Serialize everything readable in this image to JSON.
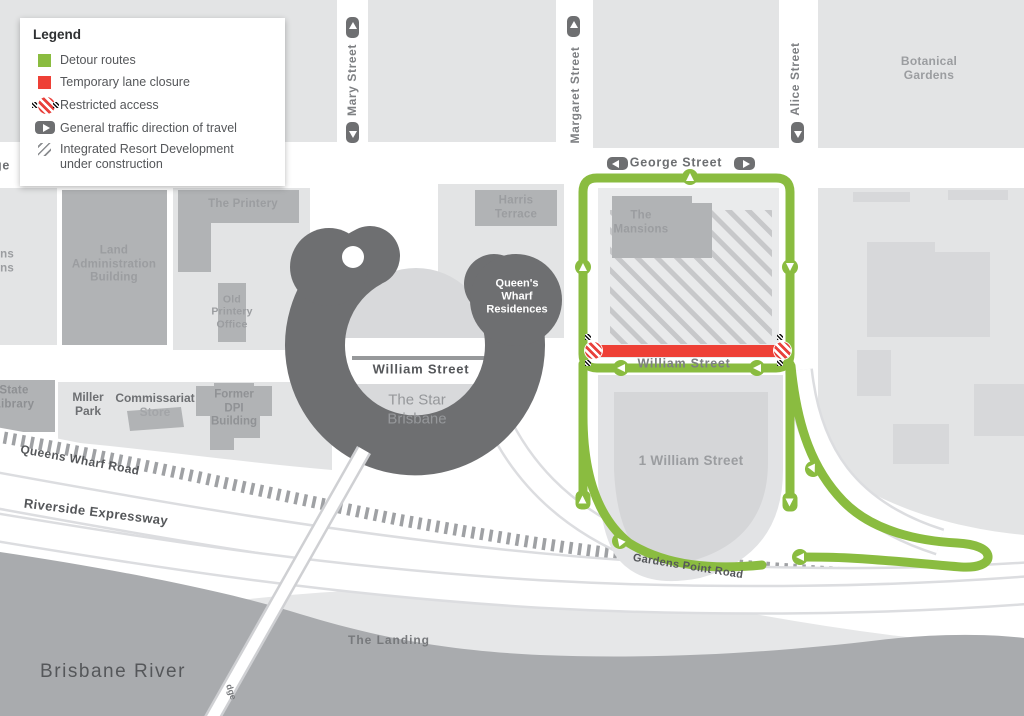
{
  "legend": {
    "title": "Legend",
    "items": {
      "detour": "Detour routes",
      "closure": "Temporary lane closure",
      "restricted": "Restricted access",
      "direction": "General traffic direction of travel",
      "construction": "Integrated Resort Development\nunder construction"
    }
  },
  "streets": {
    "mary": "Mary Street",
    "margaret": "Margaret Street",
    "alice": "Alice Street",
    "george": "George Street",
    "george_left_partial": "George",
    "william_closed": "William Street",
    "william_east": "William Street",
    "queens_wharf_road": "Queens Wharf Road",
    "riverside_expressway": "Riverside Expressway",
    "gardens_point_road": "Gardens Point Road",
    "bridge_partial": "dge"
  },
  "places": {
    "botanical_gardens": "Botanical\nGardens",
    "the_printery": "The Printery",
    "harris_terrace": "Harris\nTerrace",
    "the_mansions": "The\nMansions",
    "land_admin": "Land\nAdministration\nBuilding",
    "old_printery": "Old\nPrintery\nOffice",
    "queens_gardens_partial": "Queens\nGardens",
    "qw_residences": "Queen's\nWharf\nResidences",
    "star": "The Star\nBrisbane",
    "state_library_partial": "State\nLibrary",
    "miller_park": "Miller\nPark",
    "commissariat_line1": "Commissariat",
    "commissariat_line2": "Store",
    "former_dpi": "Former\nDPI\nBuilding",
    "one_william": "1 William Street",
    "the_landing": "The Landing",
    "brisbane_river": "Brisbane River"
  },
  "colors": {
    "detour_green": "#8abc40",
    "closure_red": "#ee4036",
    "building_gray": "#b1b3b5",
    "block_gray": "#e3e4e5",
    "star_dark": "#6e6f71",
    "river_gray": "#a9abae"
  }
}
